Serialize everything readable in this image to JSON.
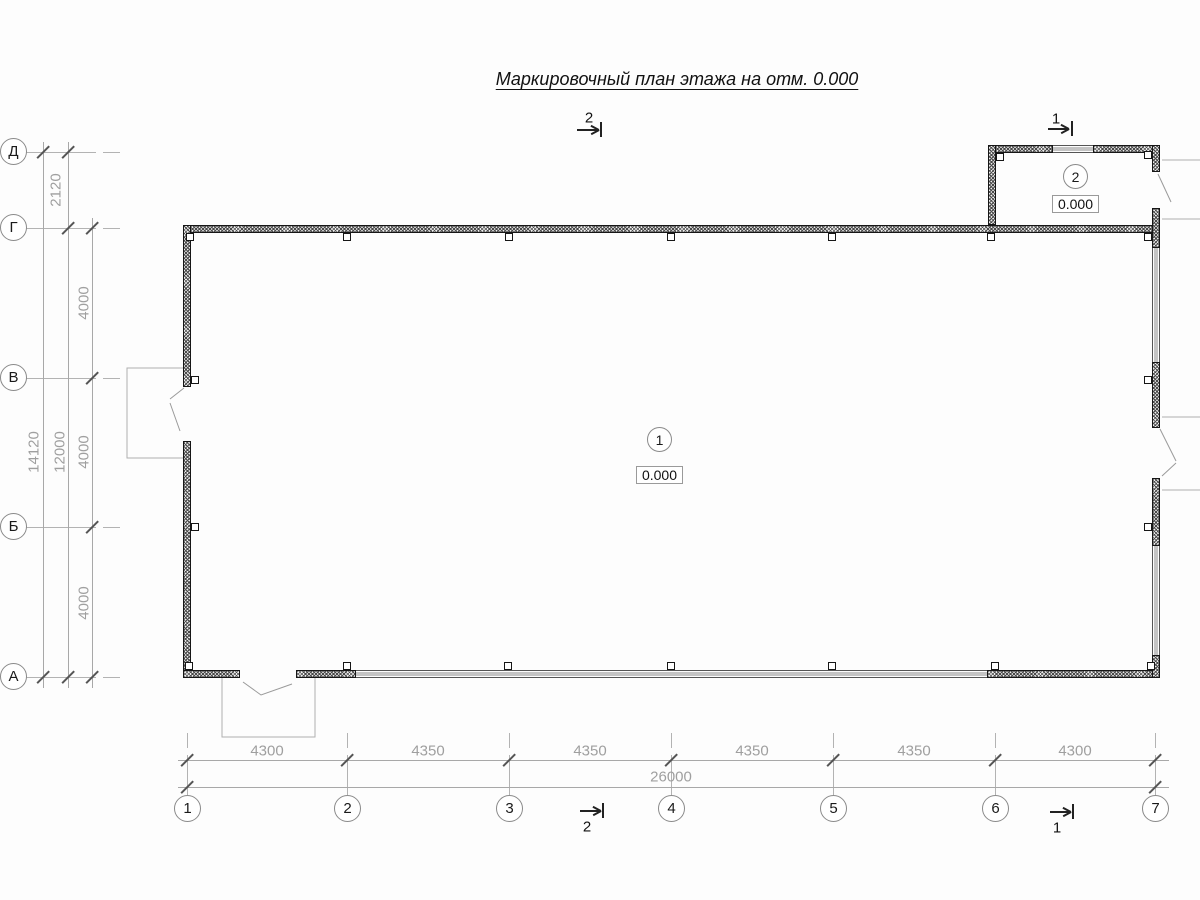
{
  "title": "Маркировочный план этажа на отм. 0.000",
  "grid": {
    "rows": [
      {
        "label": "Д"
      },
      {
        "label": "Г"
      },
      {
        "label": "В"
      },
      {
        "label": "Б"
      },
      {
        "label": "А"
      }
    ],
    "cols": [
      {
        "label": "1"
      },
      {
        "label": "2"
      },
      {
        "label": "3"
      },
      {
        "label": "4"
      },
      {
        "label": "5"
      },
      {
        "label": "6"
      },
      {
        "label": "7"
      }
    ]
  },
  "dims": {
    "left": {
      "overall": "14120",
      "upper": "2120",
      "main": "12000",
      "segments": [
        "4000",
        "4000",
        "4000"
      ]
    },
    "bottom": {
      "overall": "26000",
      "segments": [
        "4300",
        "4350",
        "4350",
        "4350",
        "4350",
        "4300"
      ]
    }
  },
  "rooms": [
    {
      "number": "1",
      "elevation": "0.000"
    },
    {
      "number": "2",
      "elevation": "0.000"
    }
  ],
  "sections": [
    {
      "label": "2"
    },
    {
      "label": "1"
    }
  ],
  "colors": {
    "wall_outline": "#161616",
    "grid_line": "#b0b0b0",
    "dim_line": "#a8a8a8",
    "dim_text": "#9f9f9f",
    "text": "#111111"
  }
}
